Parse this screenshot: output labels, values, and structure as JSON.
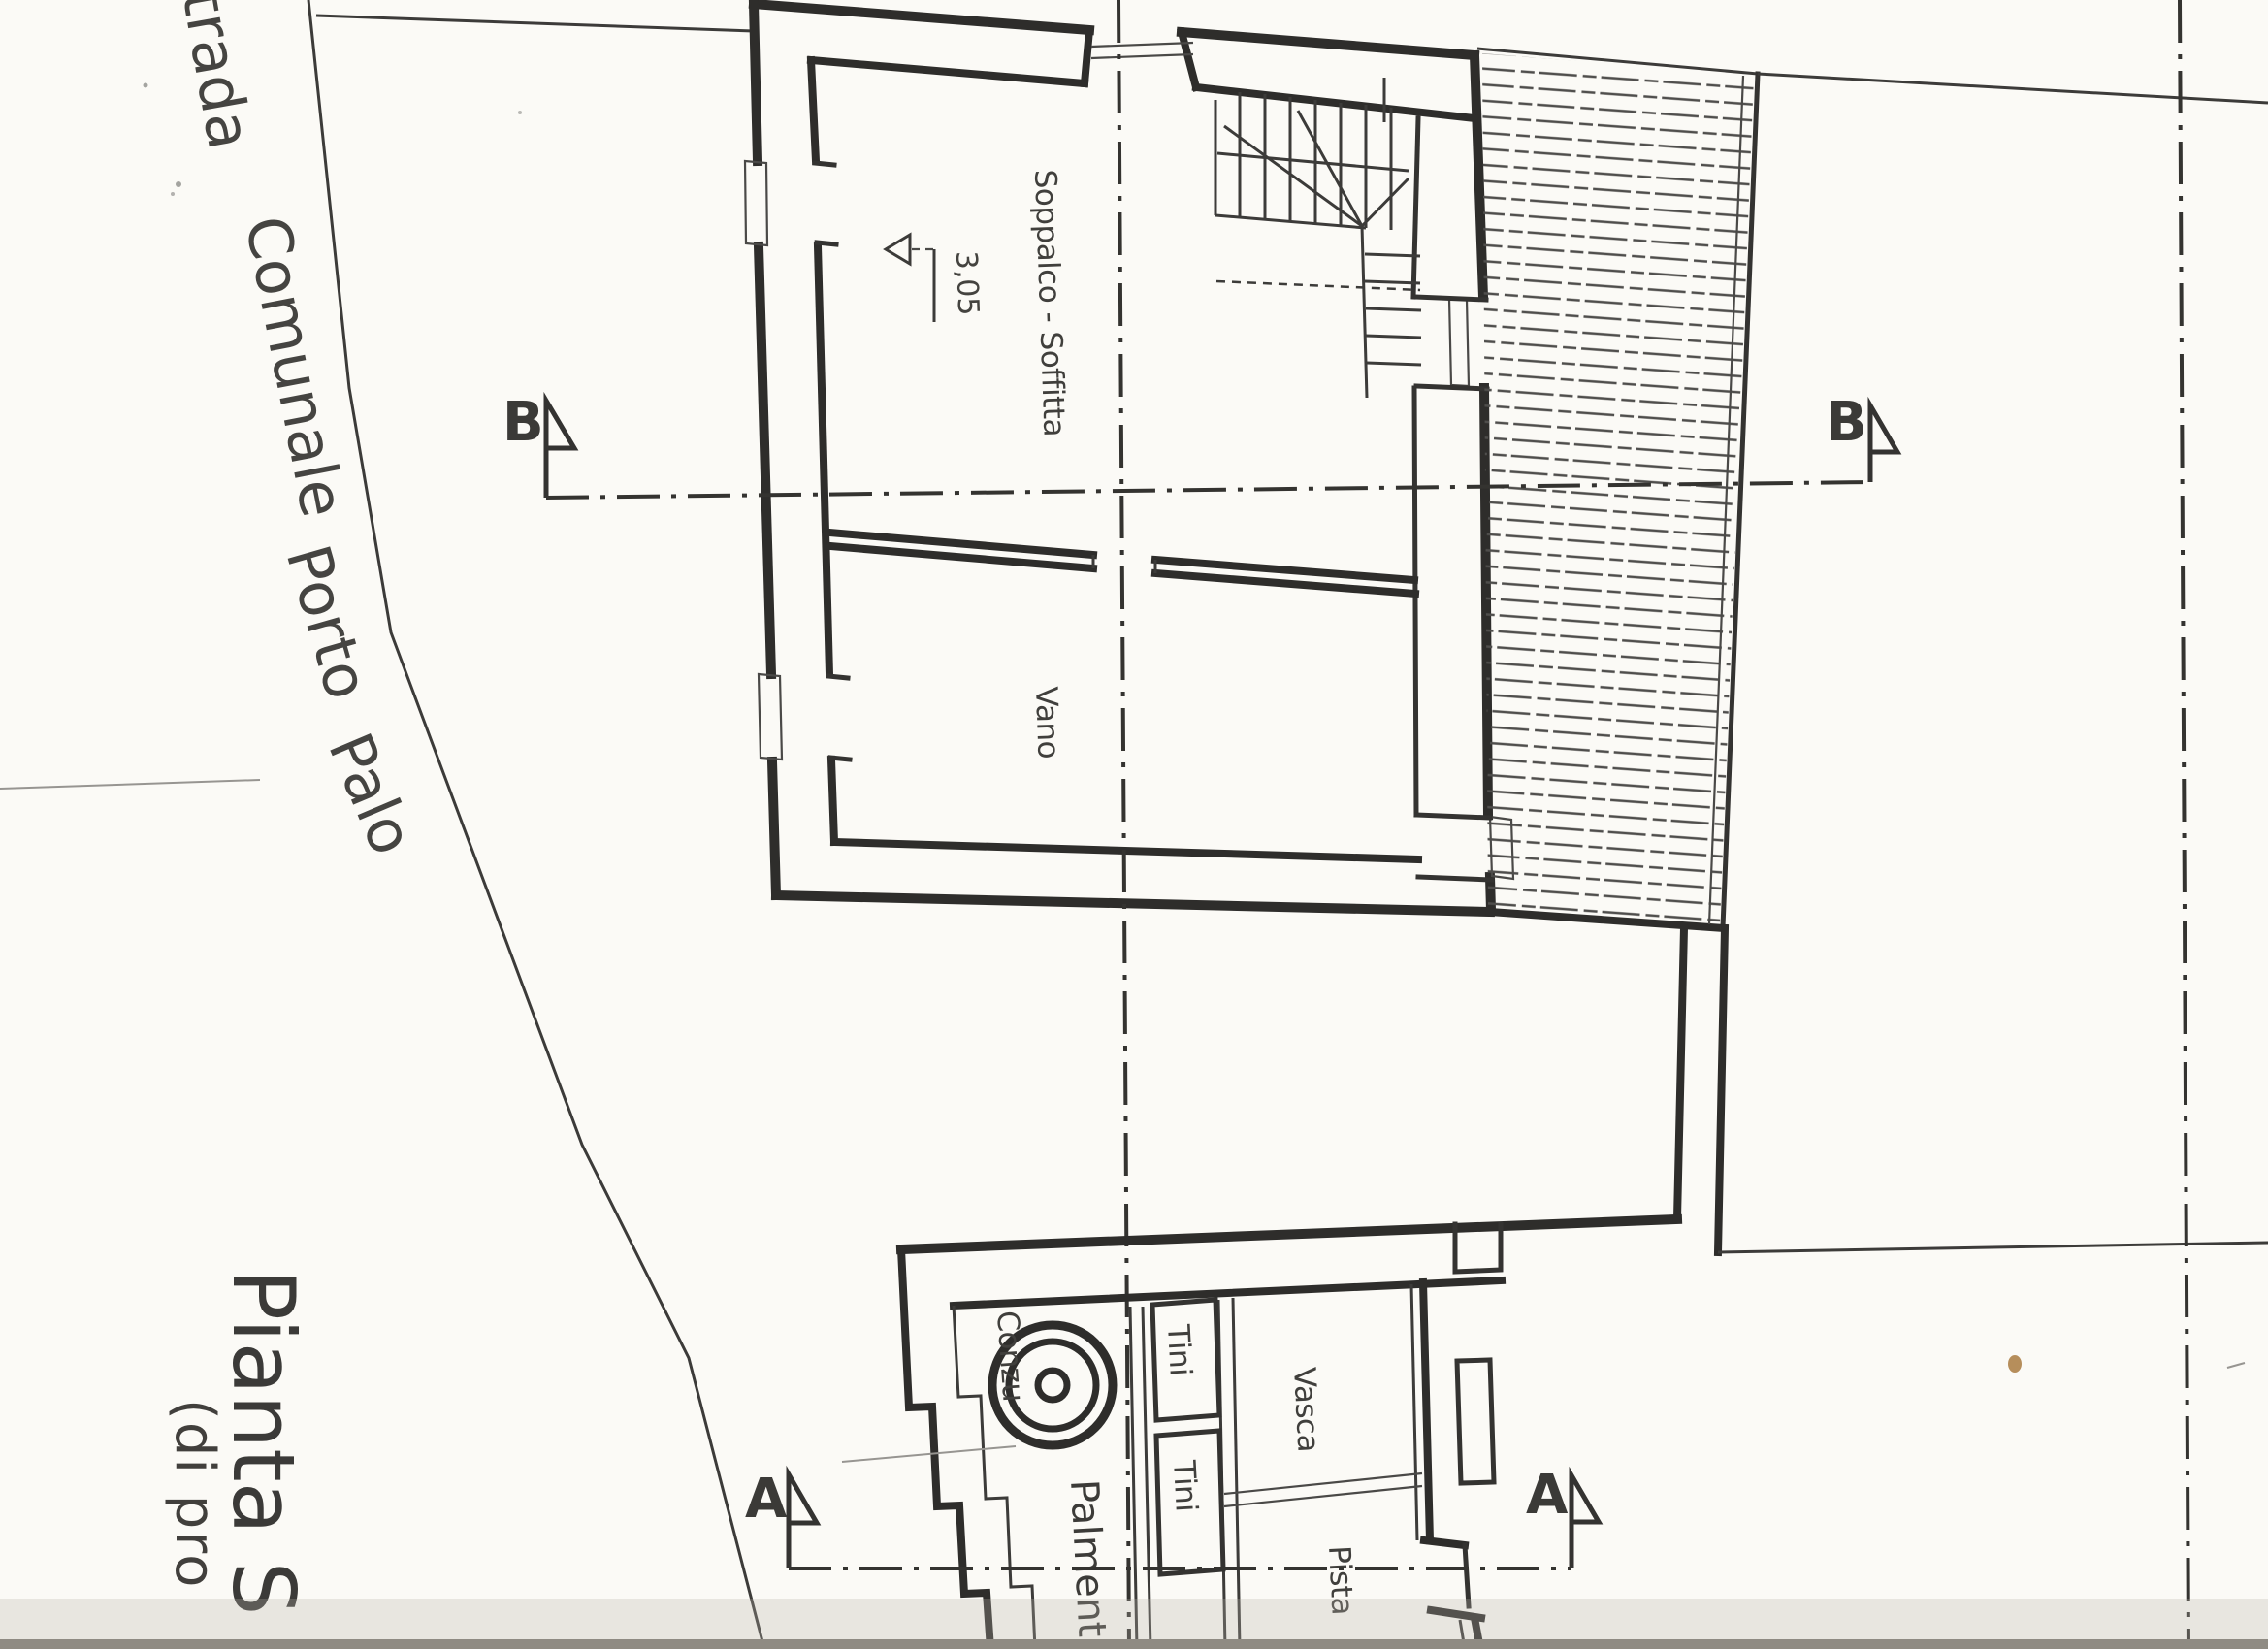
{
  "colors": {
    "paper": "#fbfaf6",
    "ink": "#2e2d2b",
    "hatch": "#4f4e4c",
    "scan_shadow": "#8f8b83",
    "stain": "#a97a40"
  },
  "title": {
    "line1": "Pianta S",
    "line2": "(di pro"
  },
  "road_labels": {
    "strada": "trada",
    "comunale": "Comunale",
    "porto": "Porto",
    "palo": "Palo"
  },
  "plan_labels": {
    "soppalco": "Soppalco - Soffitta",
    "vano": "Vano",
    "conzu": "Conzu",
    "palmento": "Palmento",
    "tini_upper": "Tini",
    "tini_lower": "Tini",
    "vasca": "Vasca",
    "pista": "Pista"
  },
  "dimensions": {
    "soppalco_width": "3,05"
  },
  "section_markers": {
    "b_left": "B",
    "b_right": "B",
    "a_left": "A",
    "a_right": "A"
  }
}
